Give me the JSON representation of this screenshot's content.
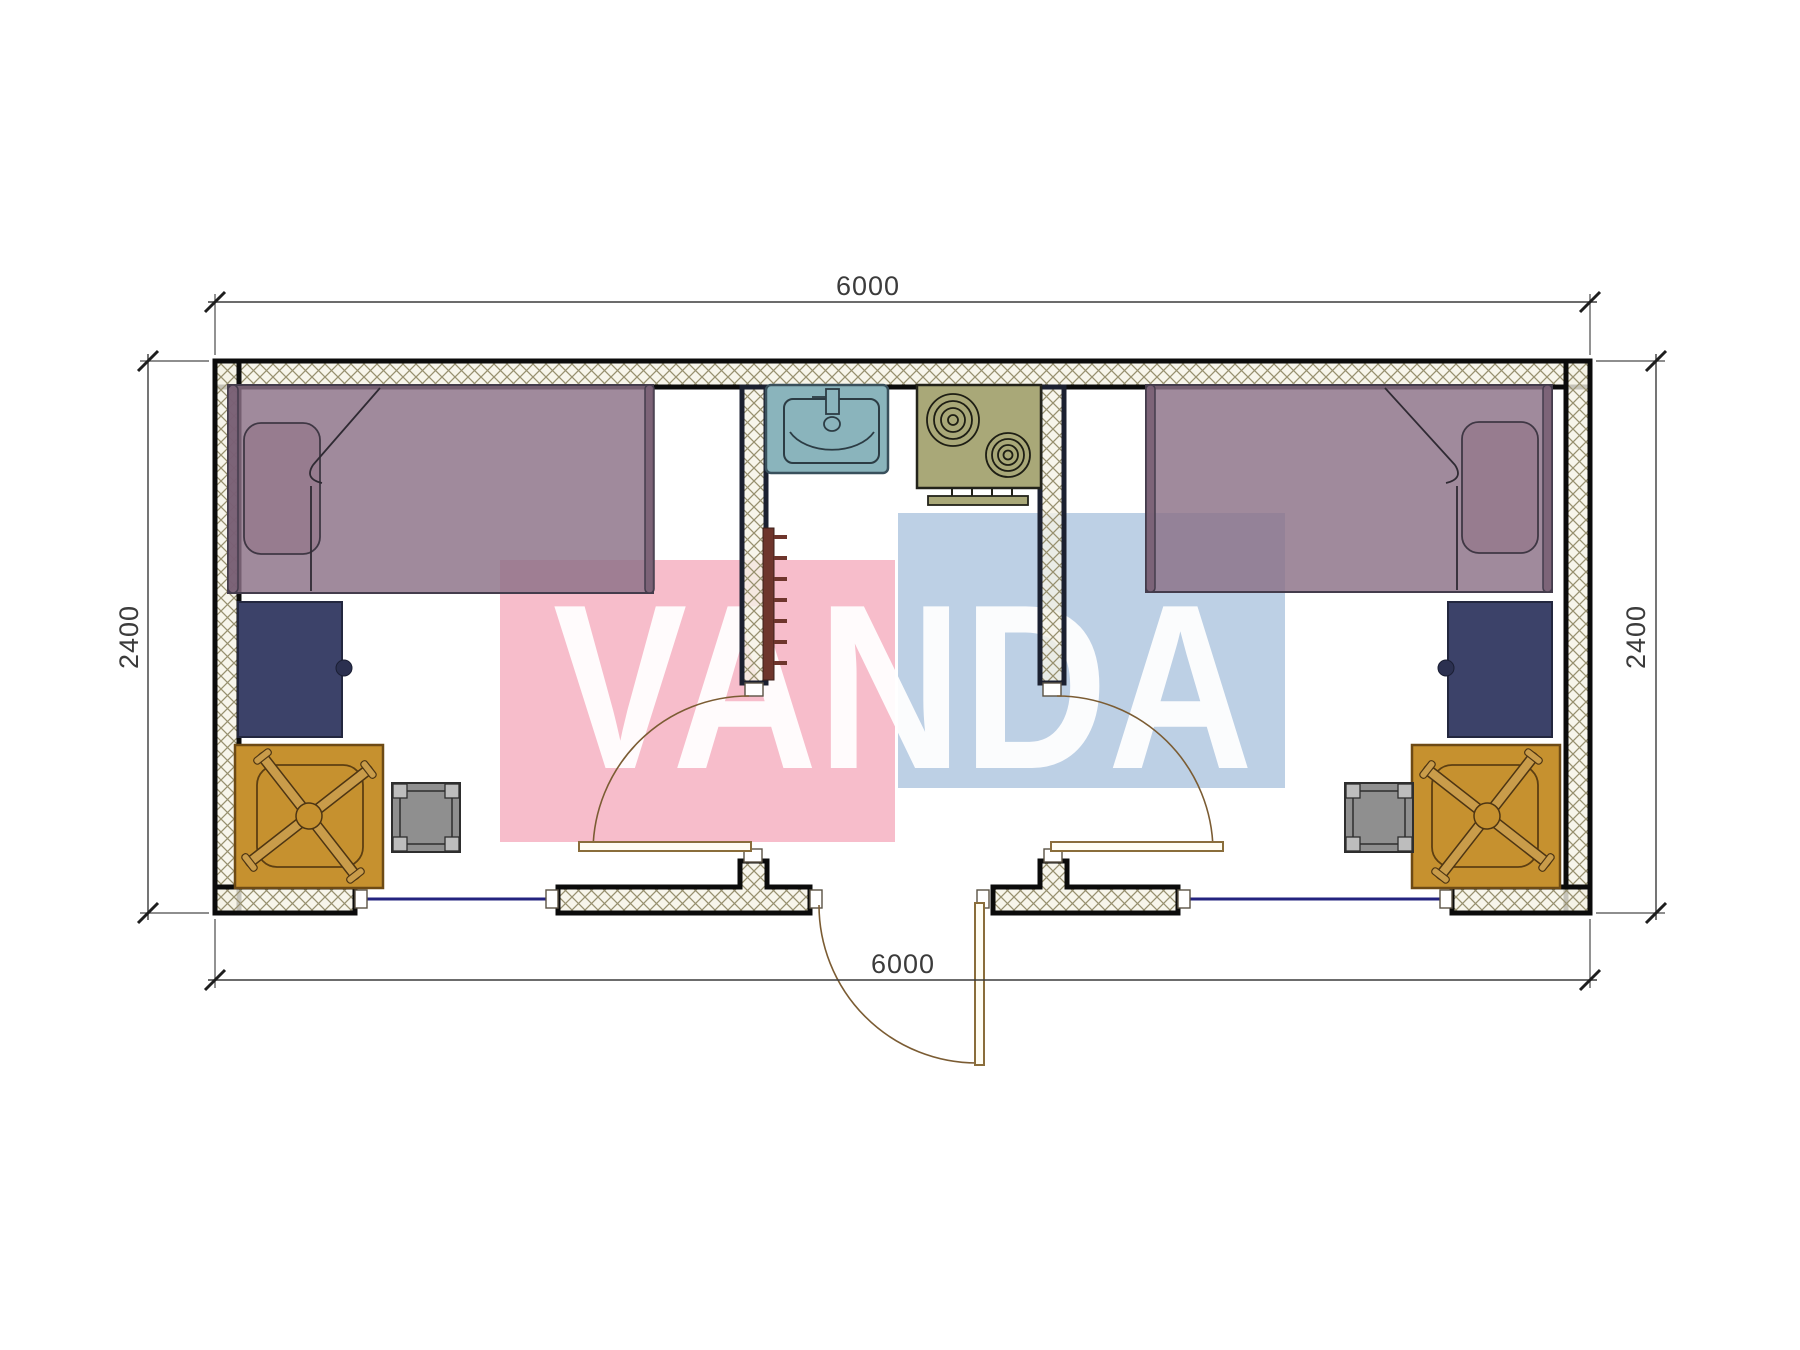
{
  "drawing": {
    "type": "floor-plan",
    "unit_label": "mm",
    "dimensions": {
      "top": "6000",
      "bottom": "6000",
      "left": "2400",
      "right": "2400"
    },
    "watermark": {
      "text": "VANDA",
      "pink_block_color": "rgba(246,178,194,0.85)",
      "blue_block_color": "rgba(178,200,224,0.85)"
    },
    "colors": {
      "wall_hatch_line": "#97906f",
      "wall_hatch_bg": "#f5f2e6",
      "bed": "rgba(139,112,134,0.82)",
      "bed_frame": "rgba(120,95,115,0.88)",
      "pillow": "rgba(150,122,142,0.9)",
      "cabinet_navy": "#3c4269",
      "desk_orange": "#c6912f",
      "chair_arm": "#c99c4a",
      "stool_gray": "#8f8f8f",
      "stool_corner": "#bdbdbd",
      "sink_teal": "#8ab4bc",
      "stove_olive": "#a9a878",
      "radiator_brown": "#6e352c",
      "window_blue": "#23237f",
      "door_brown": "#8a6d3b"
    },
    "rooms": {
      "left_room": [
        "bed",
        "pillow",
        "cabinet",
        "desk",
        "office-chair",
        "stool",
        "window",
        "door"
      ],
      "middle_room": [
        "sink",
        "stove",
        "radiator",
        "entrance-door"
      ],
      "right_room": [
        "bed",
        "pillow",
        "cabinet",
        "desk",
        "office-chair",
        "stool",
        "window",
        "door"
      ]
    }
  }
}
